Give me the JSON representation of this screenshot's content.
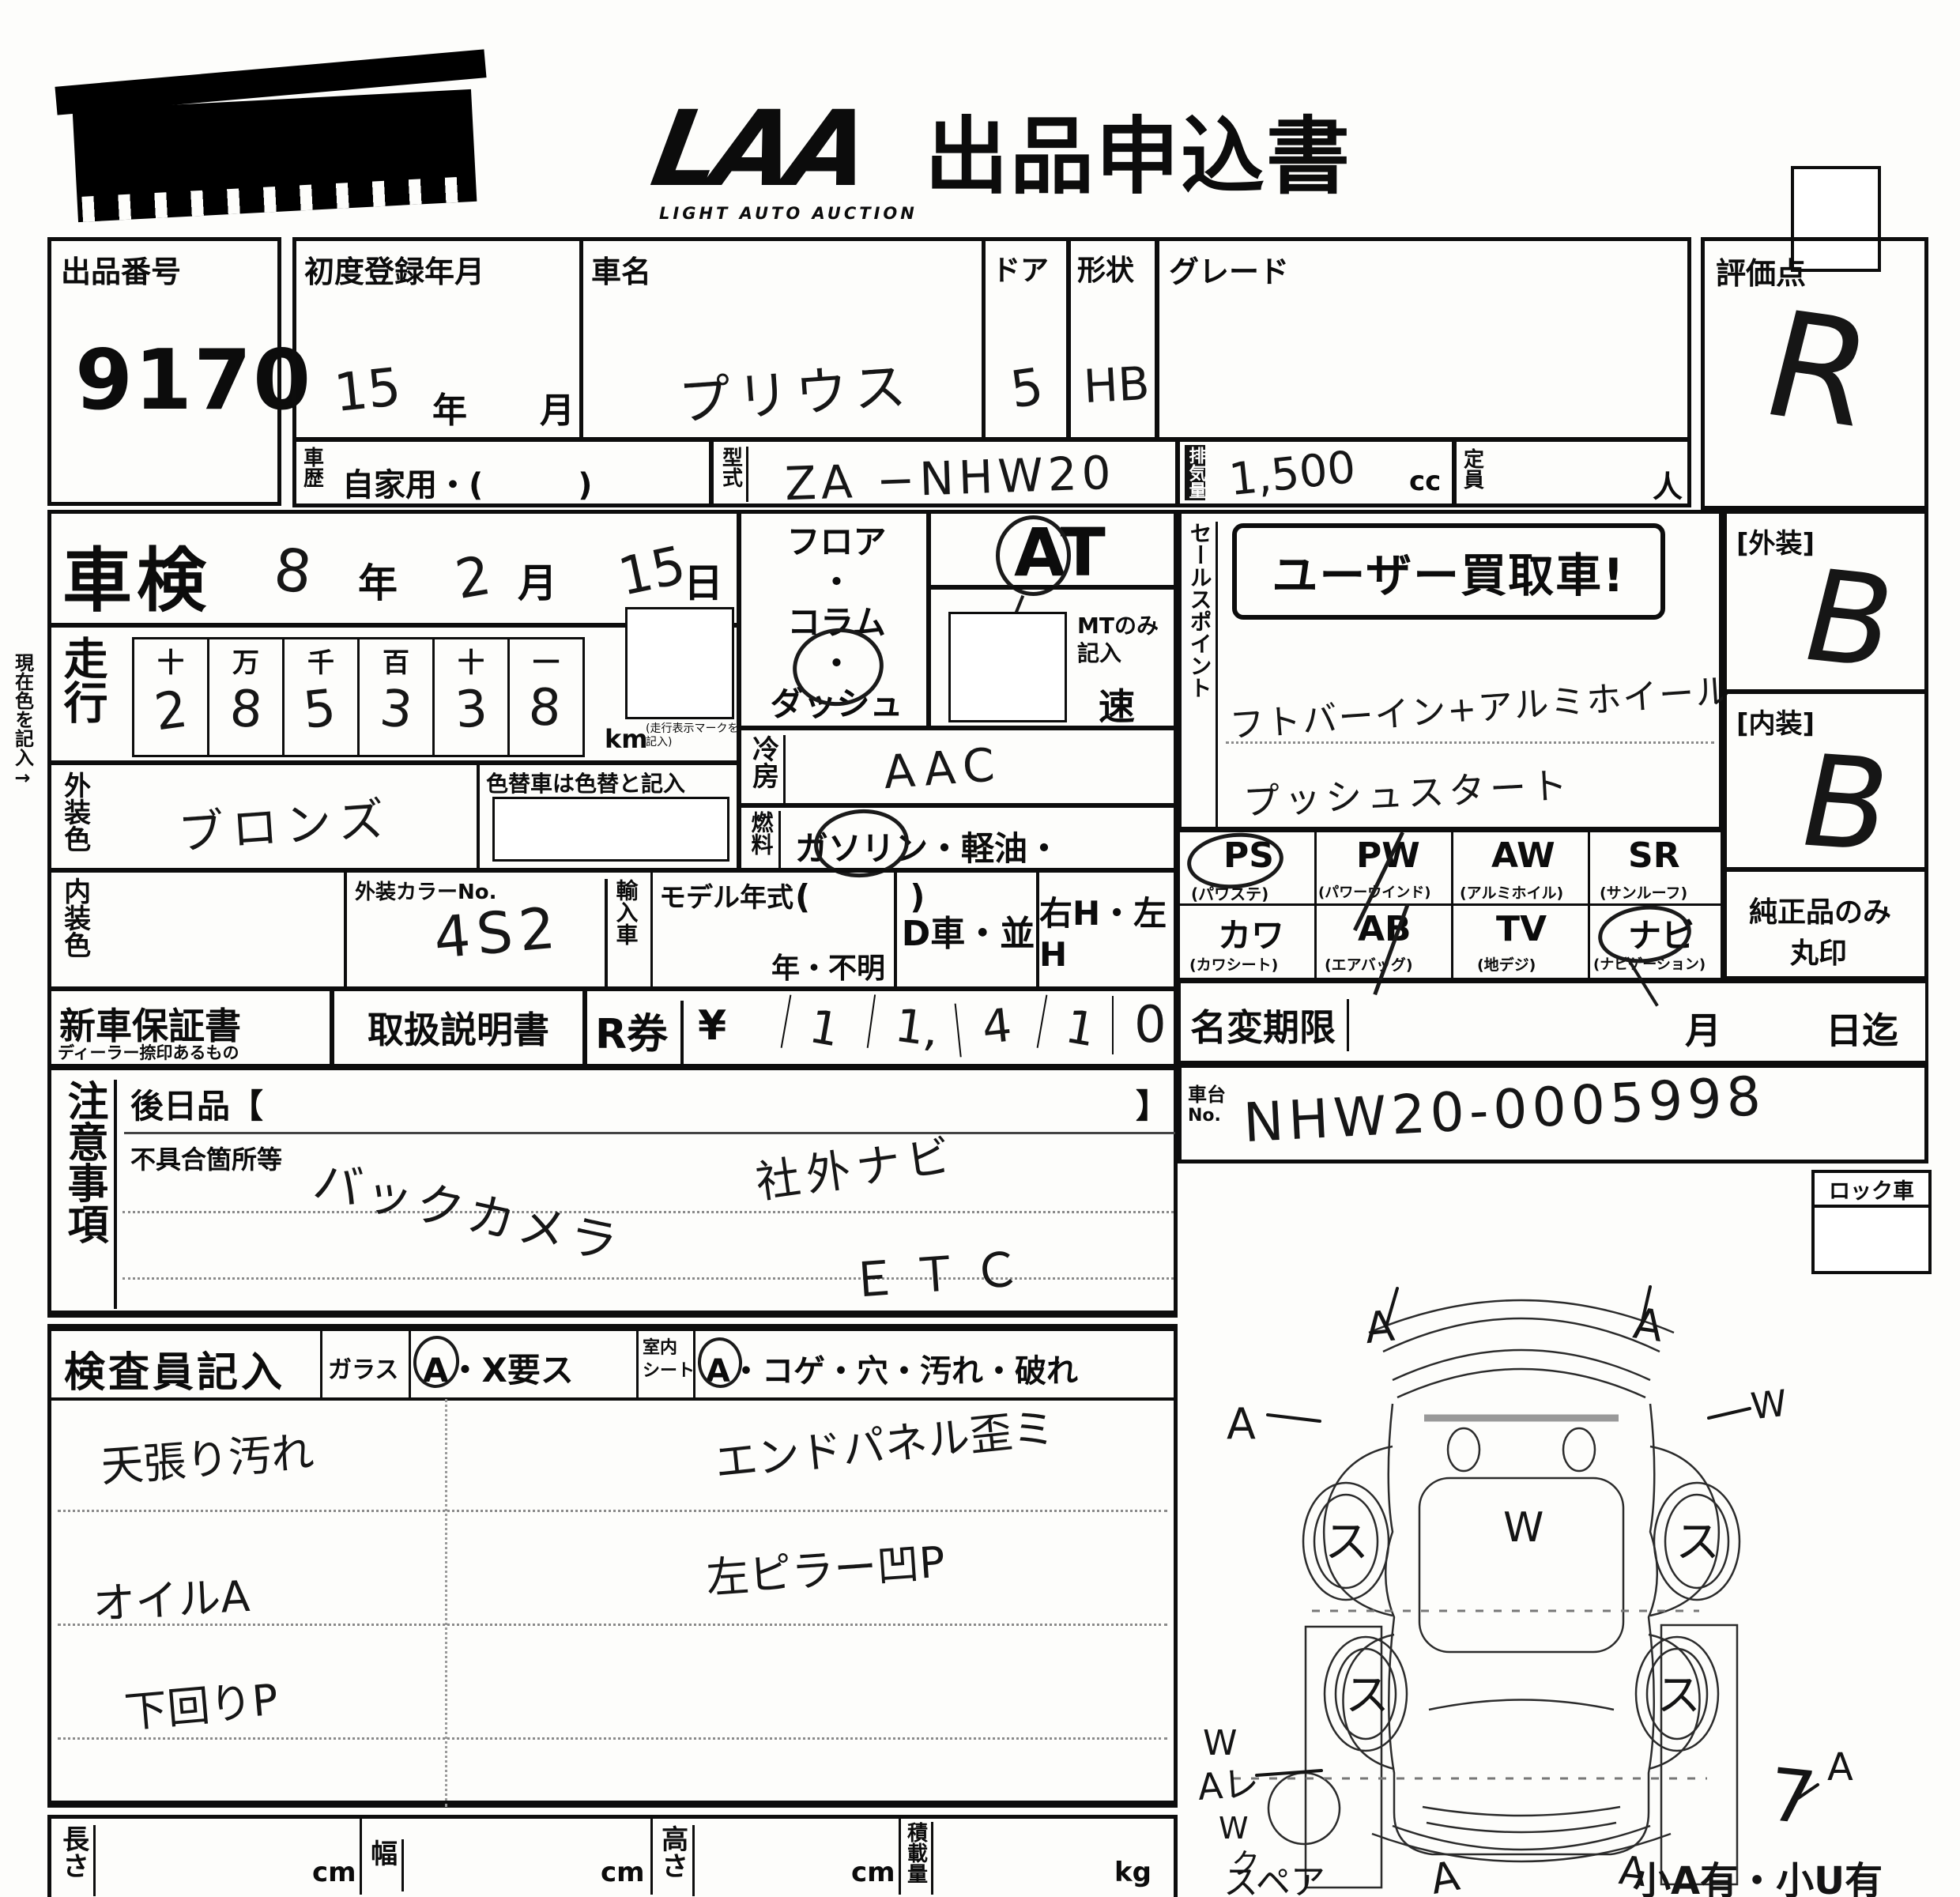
{
  "header": {
    "logo": "LAA",
    "logo_sub": "LIGHT AUTO AUCTION",
    "title": "出品申込書"
  },
  "lot": {
    "label": "出品番号",
    "value": "9170"
  },
  "row1": {
    "reg_label": "初度登録年月",
    "reg_value": "15",
    "reg_year": "年",
    "reg_month": "月",
    "name_label": "車名",
    "name_value": "プリウス",
    "door_label": "ドア",
    "door_value": "5",
    "shape_label": "形状",
    "shape_value": "HB",
    "grade_label": "グレード",
    "score_label": "評価点",
    "score_value": "R"
  },
  "row2": {
    "history_label": "車歴",
    "history_value": "自家用・(　　　)",
    "model_label": "型式",
    "model_value": "ZA −NHW20",
    "disp_label": "排気量",
    "disp_value": "1,500",
    "disp_unit": "cc",
    "cap_label": "定員",
    "cap_unit": "人"
  },
  "shaken": {
    "label": "車検",
    "year": "8",
    "year_suffix": "年",
    "month": "2",
    "month_suffix": "月",
    "day": "15",
    "day_suffix": "日"
  },
  "mileage": {
    "label": "走行",
    "headers": [
      "十",
      "万",
      "千",
      "百",
      "十",
      "一"
    ],
    "digits": [
      "2",
      "8",
      "5",
      "3",
      "3",
      "8"
    ],
    "unit": "km",
    "unit_note": "(走行表示マークを記入)"
  },
  "ext_color": {
    "label": "外装色",
    "value": "ブロンズ",
    "repaint_note": "色替車は色替と記入"
  },
  "trans": {
    "floor": "フロア",
    "dot1": "・",
    "column": "コラム",
    "dot2": "・",
    "dash": "ダッシュ",
    "at": "AT",
    "mt_note": "MTのみ記入",
    "speed": "速"
  },
  "ac": {
    "label": "冷房",
    "value": "AAC"
  },
  "fuel": {
    "label": "燃料",
    "value": "ガソリン・軽油・(　　　)"
  },
  "colors": {
    "int_label": "内装色",
    "color_no_label": "外装カラーNo.",
    "color_no_value": "4S2",
    "import_label": "輸入車",
    "model_year_label": "モデル年式",
    "model_year_note": "年・不明",
    "d_car": "D車・並",
    "handle": "右H・左H"
  },
  "sales": {
    "label": "セールスポイント",
    "stamp": "ユーザー買取車!",
    "line1": "フトバーイン+アルミホイール",
    "line2": "プッシュスタート"
  },
  "grades": {
    "ext_label": "[外装]",
    "ext_value": "B",
    "int_label": "[内装]",
    "int_value": "B"
  },
  "equipment": {
    "items": [
      {
        "code": "PS",
        "name": "(パワステ)"
      },
      {
        "code": "PW",
        "name": "(パワーウインド)"
      },
      {
        "code": "AW",
        "name": "(アルミホイル)"
      },
      {
        "code": "SR",
        "name": "(サンルーフ)"
      },
      {
        "code": "カワ",
        "name": "(カワシート)"
      },
      {
        "code": "AB",
        "name": "(エアバッグ)"
      },
      {
        "code": "TV",
        "name": "(地デジ)"
      },
      {
        "code": "ナビ",
        "name": "(ナビゲーション)"
      }
    ],
    "note1": "純正品のみ",
    "note2": "丸印"
  },
  "docs": {
    "warranty": "新車保証書",
    "warranty_sub": "ディーラー捺印あるもの",
    "manual": "取扱説明書",
    "r_label": "R券",
    "yen": "¥",
    "digits": [
      "1",
      "1,",
      "4",
      "1",
      "0"
    ]
  },
  "name_change": {
    "label": "名変期限",
    "month": "月",
    "day": "日迄"
  },
  "chassis": {
    "label1": "車台",
    "label2": "No.",
    "value": "NHW20-0005998"
  },
  "lock": {
    "label": "ロック車"
  },
  "notes": {
    "label": "注意事項",
    "later": "後日品【",
    "later_close": "】",
    "defect": "不具合箇所等",
    "entry1": "バックカメラ",
    "entry2": "社外ナビ",
    "entry3": "ＥＴＣ"
  },
  "inspector": {
    "label": "検査員記入",
    "glass": "ガラス",
    "glass_mark": "A・X要ス",
    "seat1": "室内",
    "seat2": "シート",
    "seat_mark": "A・コゲ・穴・汚れ・破れ",
    "e1": "天張り汚れ",
    "e2": "オイルA",
    "e3": "下回りP",
    "e4": "エンドパネル歪ミ",
    "e5": "左ピラー凹P"
  },
  "dims": {
    "length": "長さ",
    "width": "幅",
    "height": "高さ",
    "load": "積載量",
    "cm1": "cm",
    "cm2": "cm",
    "cm3": "cm",
    "kg": "kg"
  },
  "diagram": {
    "spare": "スペア",
    "note": "小A有・小U有",
    "a": "A",
    "w": "W",
    "su": "ス",
    "seven": "7",
    "al": "Aレ",
    "wk1": "W",
    "wk2": "ク"
  },
  "side": {
    "current_color": "現在色を記入→"
  }
}
